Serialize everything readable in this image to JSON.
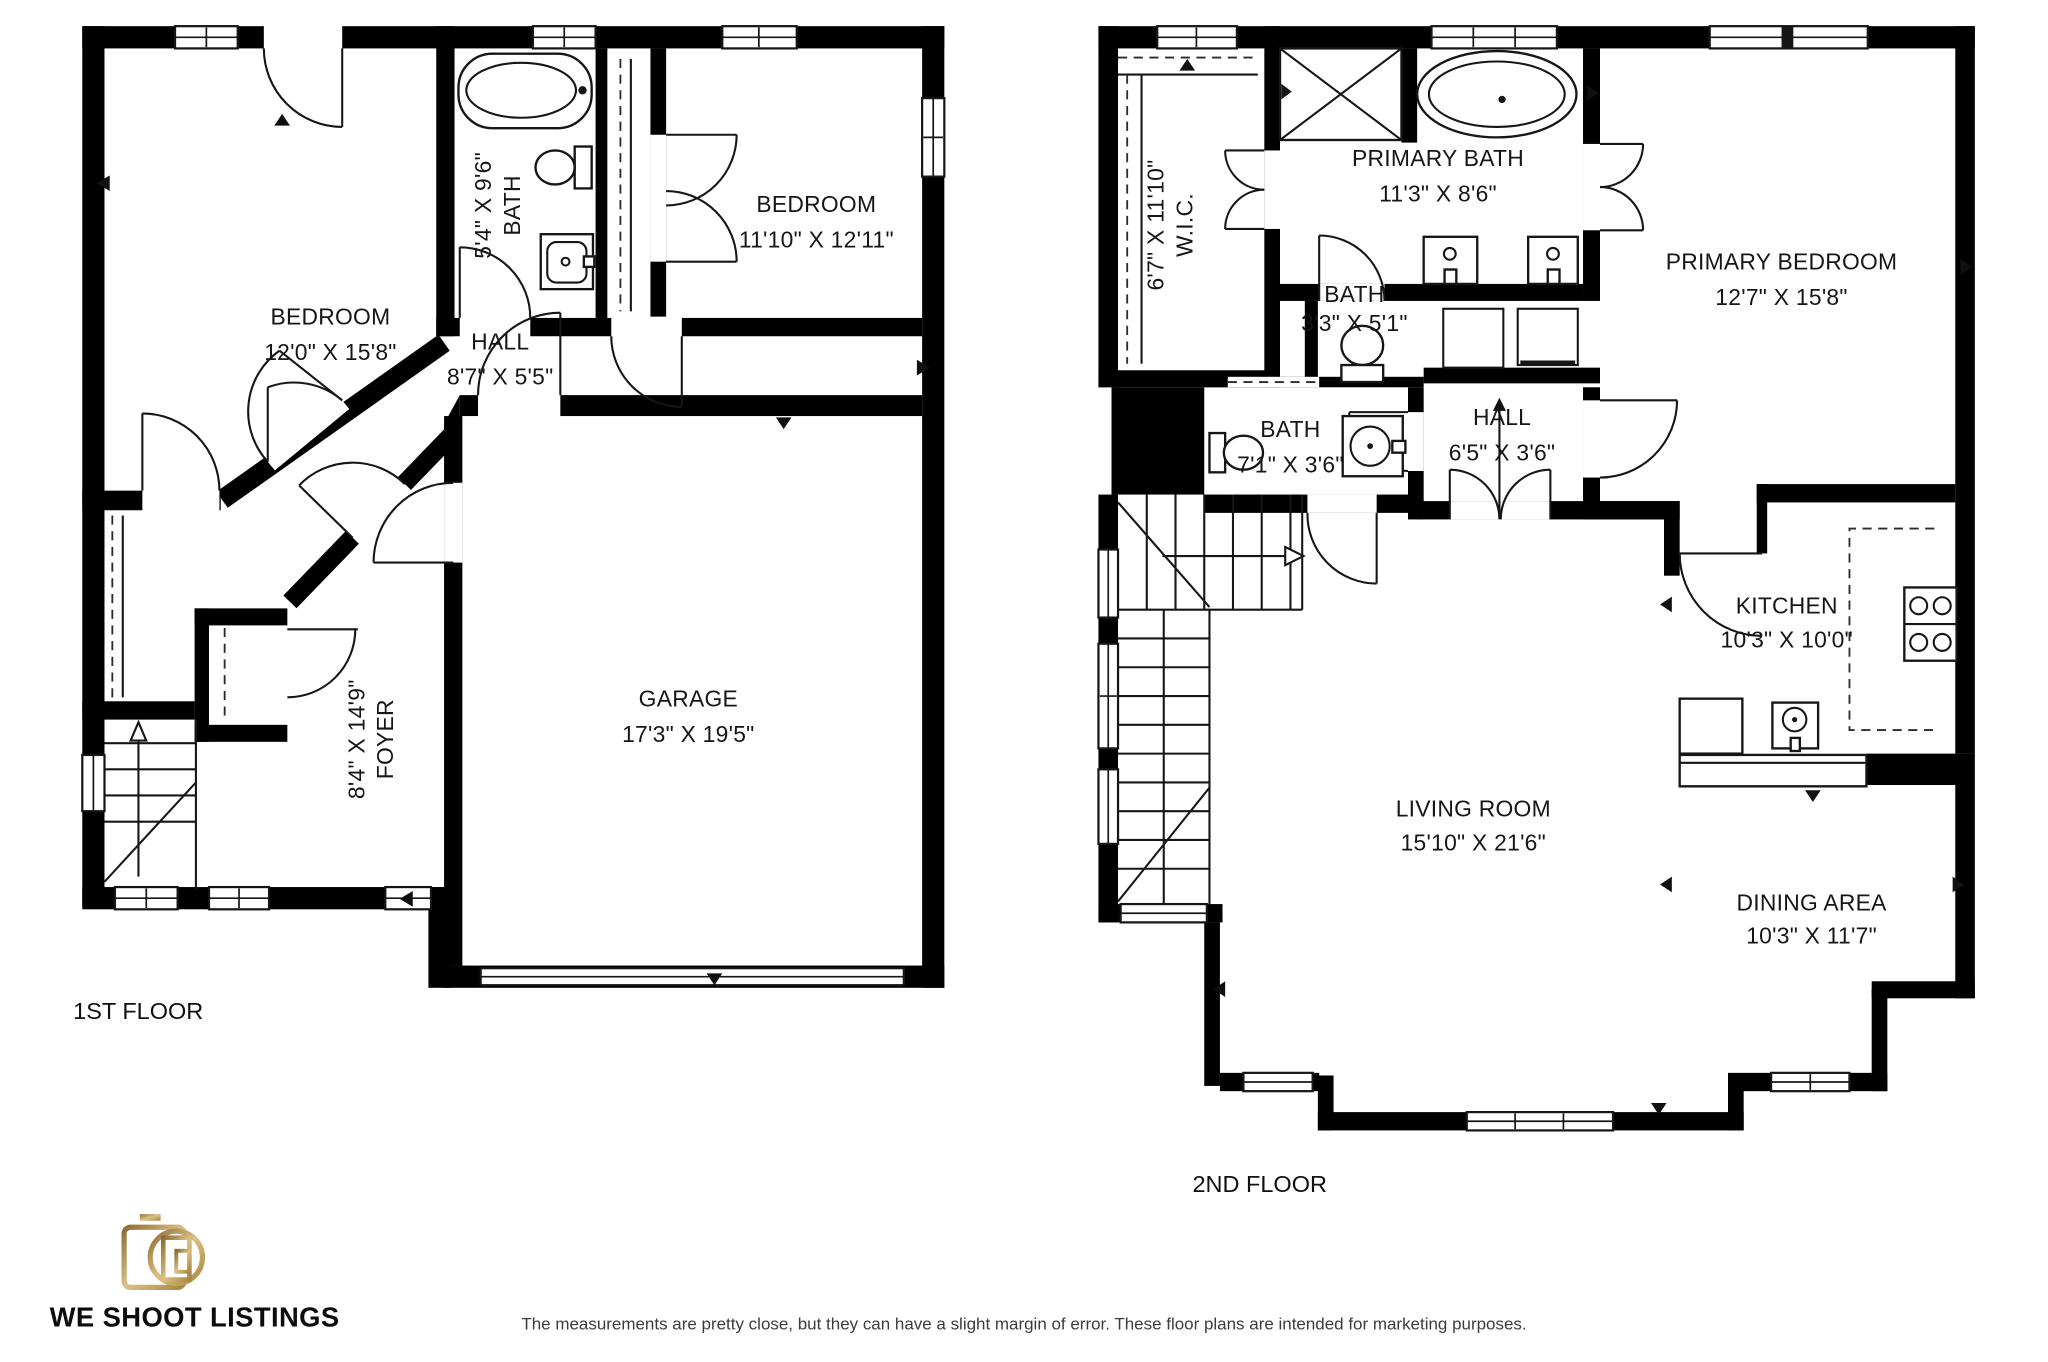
{
  "floors": [
    {
      "label": "1ST FLOOR",
      "rooms": [
        {
          "name": "BEDROOM",
          "dims": "12'0\" X 15'8\""
        },
        {
          "name": "BATH",
          "dims": "5'4\" X 9'6\""
        },
        {
          "name": "BEDROOM",
          "dims": "11'10\" X 12'11\""
        },
        {
          "name": "HALL",
          "dims": "8'7\" X 5'5\""
        },
        {
          "name": "FOYER",
          "dims": "8'4\" X 14'9\""
        },
        {
          "name": "GARAGE",
          "dims": "17'3\" X 19'5\""
        }
      ]
    },
    {
      "label": "2ND FLOOR",
      "rooms": [
        {
          "name": "W.I.C.",
          "dims": "6'7\" X 11'10\""
        },
        {
          "name": "PRIMARY BATH",
          "dims": "11'3\" X 8'6\""
        },
        {
          "name": "BATH",
          "dims": "3'3\" X 5'1\""
        },
        {
          "name": "PRIMARY BEDROOM",
          "dims": "12'7\" X 15'8\""
        },
        {
          "name": "BATH",
          "dims": "7'1\" X 3'6\""
        },
        {
          "name": "HALL",
          "dims": "6'5\" X 3'6\""
        },
        {
          "name": "KITCHEN",
          "dims": "10'3\" X 10'0\""
        },
        {
          "name": "LIVING ROOM",
          "dims": "15'10\" X 21'6\""
        },
        {
          "name": "DINING AREA",
          "dims": "10'3\" X 11'7\""
        }
      ]
    }
  ],
  "brand": {
    "name": "WE SHOOT LISTINGS",
    "icon": "camera-icon",
    "accent_color": "#b3924f"
  },
  "disclaimer": "The measurements are pretty close, but they can have a slight margin of error. These floor plans are intended for marketing purposes.",
  "colors": {
    "walls": "#000000",
    "background": "#ffffff",
    "text": "#161616"
  }
}
